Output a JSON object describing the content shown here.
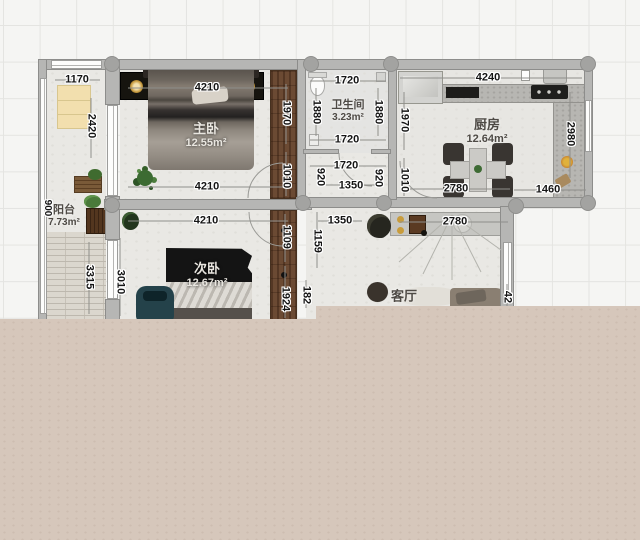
{
  "app": {
    "type": "floor-plan-editor-canvas",
    "units": "mm"
  },
  "colors": {
    "bottom_mask_beige": "#d6c7bb",
    "wall_gray": "#b6b6b4",
    "wardrobe_wood_brown": "#6b4a33",
    "floor_light": "#e9e8e4",
    "balcony_cabinet_yellow": "#f2dfae",
    "grid_line": "#e4e4e1"
  },
  "rooms": [
    {
      "id": "master-bedroom",
      "label": "主卧",
      "area": "12.55m²"
    },
    {
      "id": "bathroom",
      "label": "卫生间",
      "area": "3.23m²"
    },
    {
      "id": "kitchen",
      "label": "厨房",
      "area": "12.64m²"
    },
    {
      "id": "second-bedroom",
      "label": "次卧",
      "area": "12.67m²"
    },
    {
      "id": "living-room",
      "label": "客厅",
      "area": ""
    },
    {
      "id": "balcony",
      "label": "阳台",
      "area": "7.73m²"
    }
  ],
  "dimensions": [
    {
      "text": "1170"
    },
    {
      "text": "2420"
    },
    {
      "text": "900"
    },
    {
      "text": "3315"
    },
    {
      "text": "4210"
    },
    {
      "text": "4210"
    },
    {
      "text": "1970"
    },
    {
      "text": "1010"
    },
    {
      "text": "1720"
    },
    {
      "text": "1880"
    },
    {
      "text": "1880"
    },
    {
      "text": "1720"
    },
    {
      "text": "1720"
    },
    {
      "text": "920"
    },
    {
      "text": "920"
    },
    {
      "text": "1350"
    },
    {
      "text": "4240"
    },
    {
      "text": "1970"
    },
    {
      "text": "1010"
    },
    {
      "text": "2980"
    },
    {
      "text": "2780"
    },
    {
      "text": "1460"
    },
    {
      "text": "4210"
    },
    {
      "text": "3010"
    },
    {
      "text": "1109"
    },
    {
      "text": "1924"
    },
    {
      "text": "1159"
    },
    {
      "text": "182"
    },
    {
      "text": "1350"
    },
    {
      "text": "2780"
    },
    {
      "text": "42"
    }
  ]
}
